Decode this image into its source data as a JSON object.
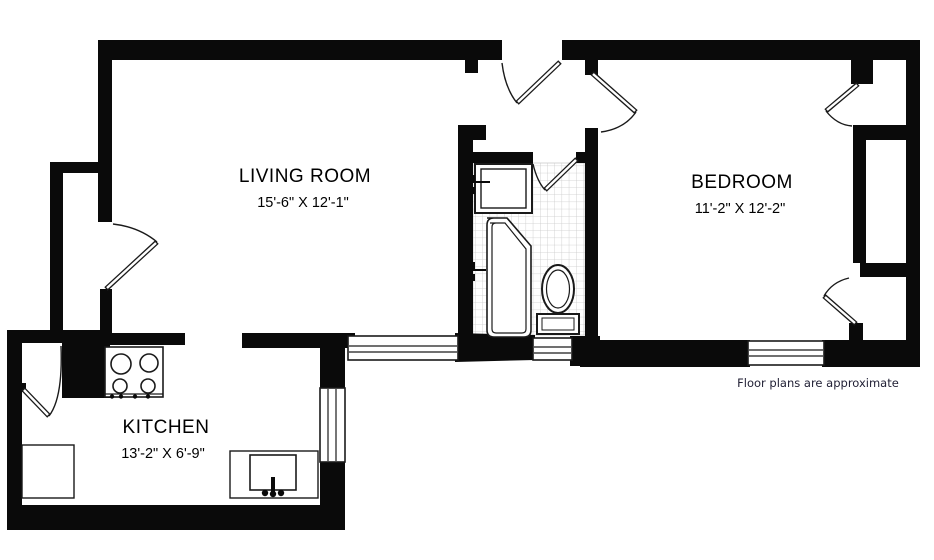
{
  "plan": {
    "title": "Apartment floor plan",
    "rooms": [
      {
        "id": "living-room",
        "name": "LIVING ROOM",
        "dimensions": "15'-6\" X 12'-1\""
      },
      {
        "id": "bedroom",
        "name": "BEDROOM",
        "dimensions": "11'-2\" X 12'-2\""
      },
      {
        "id": "kitchen",
        "name": "KITCHEN",
        "dimensions": "13'-2\" X 6'-9\""
      }
    ],
    "bathroom": {
      "fixtures": [
        "sink",
        "bathtub",
        "toilet"
      ],
      "floor": "tiled"
    },
    "kitchen_fixtures": [
      "stove",
      "counter",
      "sink"
    ],
    "doors": [
      "entry-door",
      "bedroom-door",
      "bathroom-door",
      "living-room-closet-door",
      "kitchen-service-door",
      "bedroom-closet-door-top",
      "bedroom-closet-door-bottom"
    ],
    "windows": [
      "living-room-window",
      "kitchen-window",
      "bathroom-window",
      "bedroom-window"
    ],
    "disclaimer": "Floor plans are approximate",
    "colors": {
      "wall": "#0a0a0a",
      "background": "#ffffff",
      "tile_line": "#c9c9c9",
      "text": "#000000",
      "disclaimer_text": "#1f1e33"
    }
  }
}
